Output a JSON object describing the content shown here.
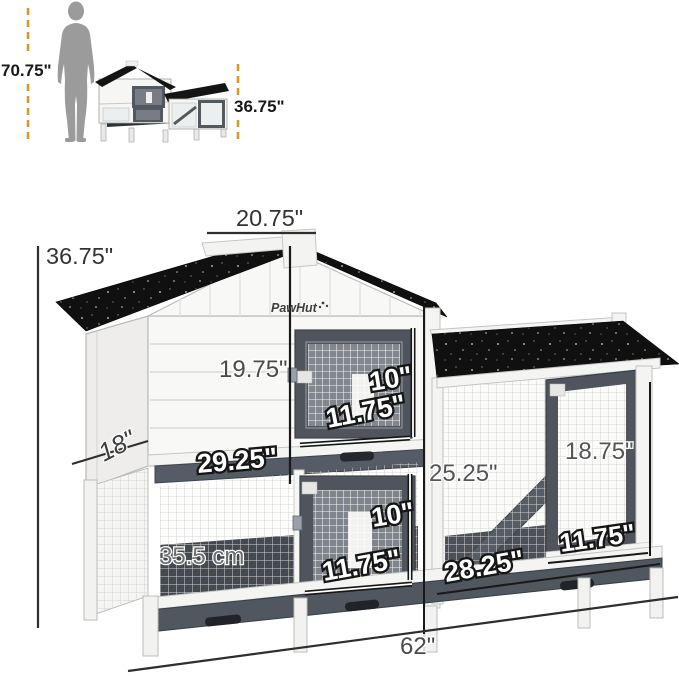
{
  "brand": {
    "logo_text": "PawHut"
  },
  "size_comparison": {
    "person_height": "70.75\"",
    "product_height": "36.75\""
  },
  "dimensions": {
    "ridge_width": "20.75\"",
    "total_height": "36.75\"",
    "upper_wall_height": "19.75\"",
    "upper_door_height": "10\"",
    "upper_door_width": "11.75\"",
    "depth": "18\"",
    "upper_section_width": "29.25\"",
    "lower_left_height": "35.5 cm",
    "lower_door_height": "10\"",
    "lower_door_width": "11.75\"",
    "run_height": "25.25\"",
    "run_door_height": "18.75\"",
    "run_width": "28.25\"",
    "run_door_width": "11.75\"",
    "total_width": "62\""
  },
  "colors": {
    "accent_dash": "#d39b35",
    "silhouette": "#9b9b9b",
    "roof": "#101010",
    "door_frame": "#50555d",
    "body_white": "#f7f7f5"
  }
}
